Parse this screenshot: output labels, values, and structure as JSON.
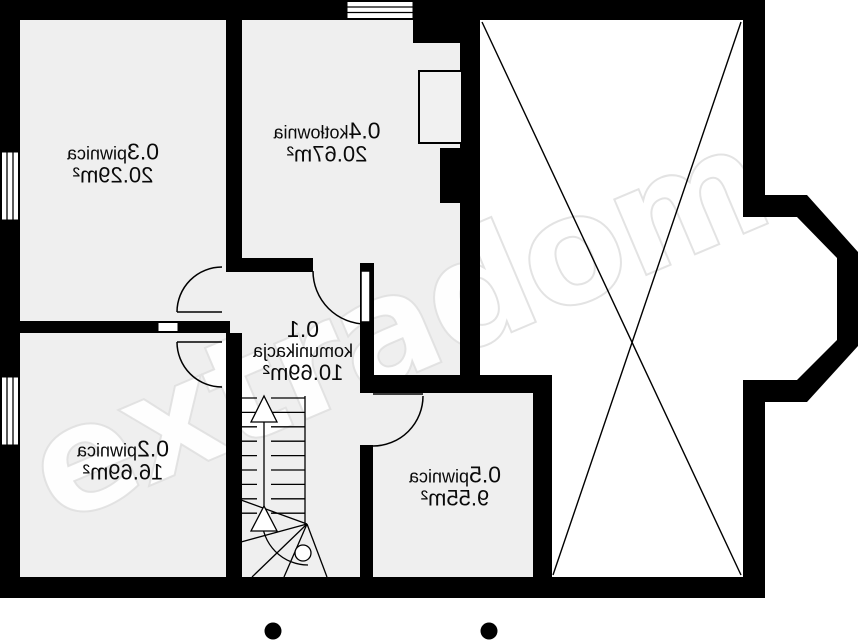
{
  "watermark": "extradom",
  "rooms": {
    "r01": {
      "number": "0.1",
      "name": "komunikacja",
      "area": "10.69m²"
    },
    "r02": {
      "number": "0.2",
      "name": "piwnica",
      "area": "16.69m²"
    },
    "r03": {
      "number": "0.3",
      "name": "piwnica",
      "area": "20.29m²"
    },
    "r04": {
      "number": "0.4",
      "name": "kotłownia",
      "area": "20.67m²"
    },
    "r05": {
      "number": "0.5",
      "name": "piwnica",
      "area": "9.55m²"
    }
  },
  "colors": {
    "wall": "#000000",
    "floor": "#efefef",
    "background": "#ffffff",
    "watermark_outline": "#dedede"
  }
}
